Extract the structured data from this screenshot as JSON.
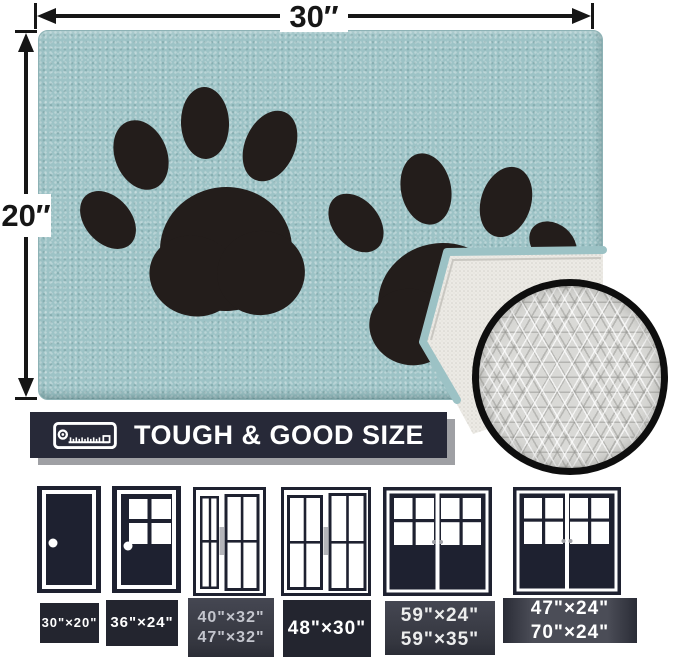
{
  "palette": {
    "mat_teal": "#9dc3c6",
    "paw_black": "#231d1b",
    "underside_white": "#ecebe6",
    "backing_gray": "#d9d9d6",
    "banner_navy": "#272938",
    "banner_shadow_gray": "#9fa0a4",
    "door_navy": "#1e2130",
    "label_box_dark": "#23252f",
    "arrow_black": "#161616",
    "text_white": "#ffffff"
  },
  "dimensions": {
    "width_label": "30″",
    "height_label": "20″"
  },
  "banner": {
    "title": "TOUGH & GOOD SIZE",
    "icon": "tape-measure-icon"
  },
  "door_sizes": [
    {
      "style": "solid-single-door",
      "lines": [
        "30\"×20\""
      ]
    },
    {
      "style": "half-glass-single-door",
      "lines": [
        "36\"×24\""
      ]
    },
    {
      "style": "sliding-door-narrow-wide",
      "lines": [
        "40\"×32\"",
        "47\"×32\""
      ]
    },
    {
      "style": "sliding-door-equal",
      "lines": [
        "48\"×30\""
      ]
    },
    {
      "style": "double-french-door",
      "lines": [
        "59\"×24\"",
        "59\"×35\""
      ]
    },
    {
      "style": "double-french-door-wide",
      "lines": [
        "47\"×24\"",
        "70\"×24\""
      ]
    }
  ]
}
